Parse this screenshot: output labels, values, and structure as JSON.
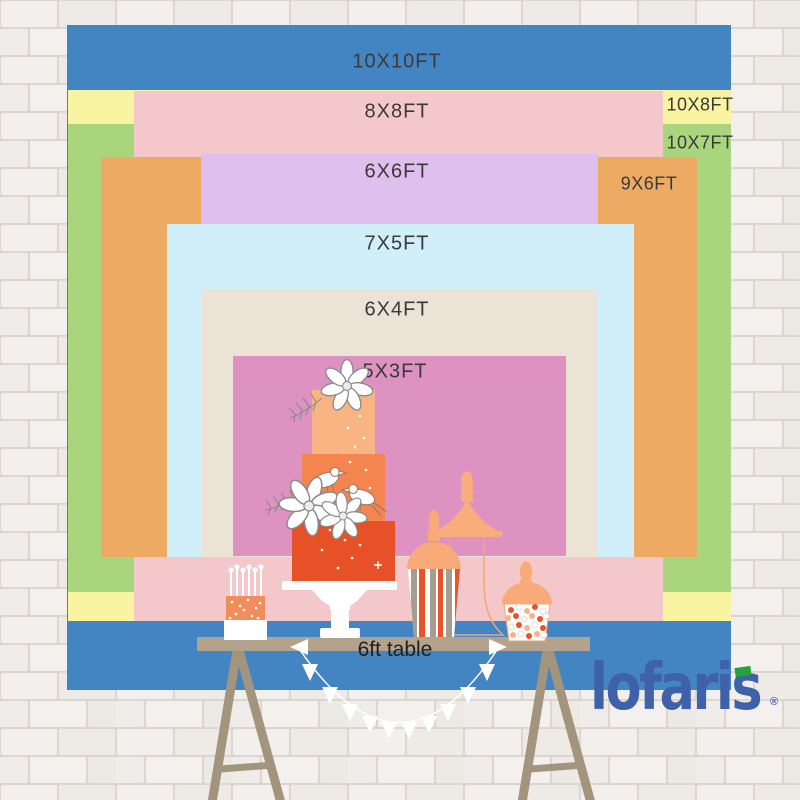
{
  "backdrop": {
    "text_color": "#3a3a3a",
    "sizes": {
      "s10x10": {
        "label": "10X10FT",
        "color": "#4385c3"
      },
      "s10x8": {
        "label": "10X8FT",
        "color": "#f9f4a2"
      },
      "s10x7": {
        "label": "10X7FT",
        "color": "#a9d57c"
      },
      "s8x8": {
        "label": "8X8FT",
        "color": "#f4c8cb"
      },
      "s9x6": {
        "label": "9X6FT",
        "color": "#ecaa62"
      },
      "s6x6": {
        "label": "6X6FT",
        "color": "#dfbfed"
      },
      "s7x5": {
        "label": "7X5FT",
        "color": "#d0eff8"
      },
      "s6x4": {
        "label": "6X4FT",
        "color": "#ebe4d6"
      },
      "s5x3": {
        "label": "5X3FT",
        "color": "#de92c2"
      }
    }
  },
  "table": {
    "label": "6ft table",
    "text_color": "#1f1f1f"
  },
  "brand": {
    "name": "lofaris",
    "registered_mark": "®",
    "logo_color": "#3e61a9",
    "logo_accent_color": "#27a23b"
  },
  "decor_icons": [
    "brick-wall-texture",
    "trestle-table-icon",
    "pennant-banner-icon",
    "three-tier-cake-icon",
    "candle-cake-icon",
    "cake-stand-icon",
    "apothecary-jar-icon",
    "striped-candy-jar-icon",
    "candy-jar-icon",
    "flower-icon",
    "fern-leaf-icon",
    "bird-icon",
    "sparkle-icon"
  ]
}
